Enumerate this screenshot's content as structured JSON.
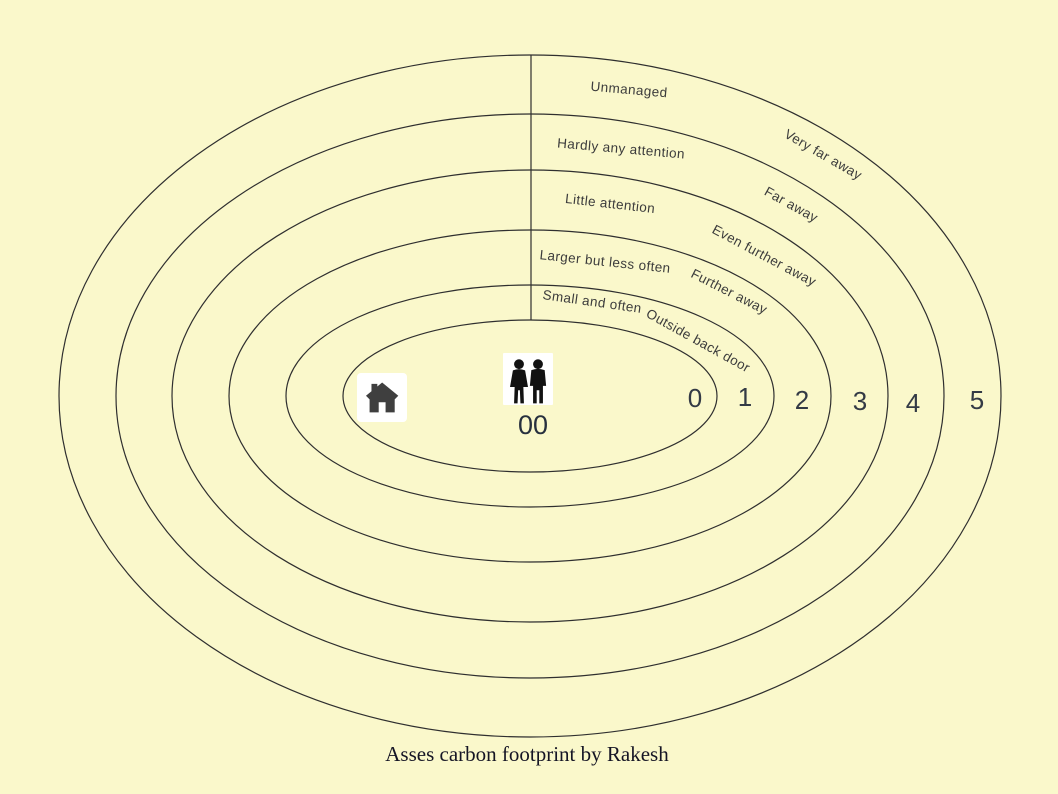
{
  "background_color": "#FAF8CB",
  "caption": "Asses carbon footprint by Rakesh",
  "diagram": {
    "type": "concentric-zone-diagram",
    "line_color": "#2f2f2f",
    "label_color": "#3c3c3c",
    "center": {
      "label": "00",
      "icons": [
        {
          "name": "home-icon",
          "meaning": "house at centre zone"
        },
        {
          "name": "people-icon",
          "meaning": "two people, zone 00"
        }
      ]
    },
    "zone_numbers": [
      "0",
      "1",
      "2",
      "3",
      "4",
      "5"
    ],
    "rings_left_labels": [
      "Small and often",
      "Larger but less often",
      "Little attention",
      "Hardly any attention",
      "Unmanaged"
    ],
    "rings_right_labels": [
      "Outside back door",
      "Further away",
      "Even further away",
      "Far away",
      "Very far away"
    ]
  }
}
